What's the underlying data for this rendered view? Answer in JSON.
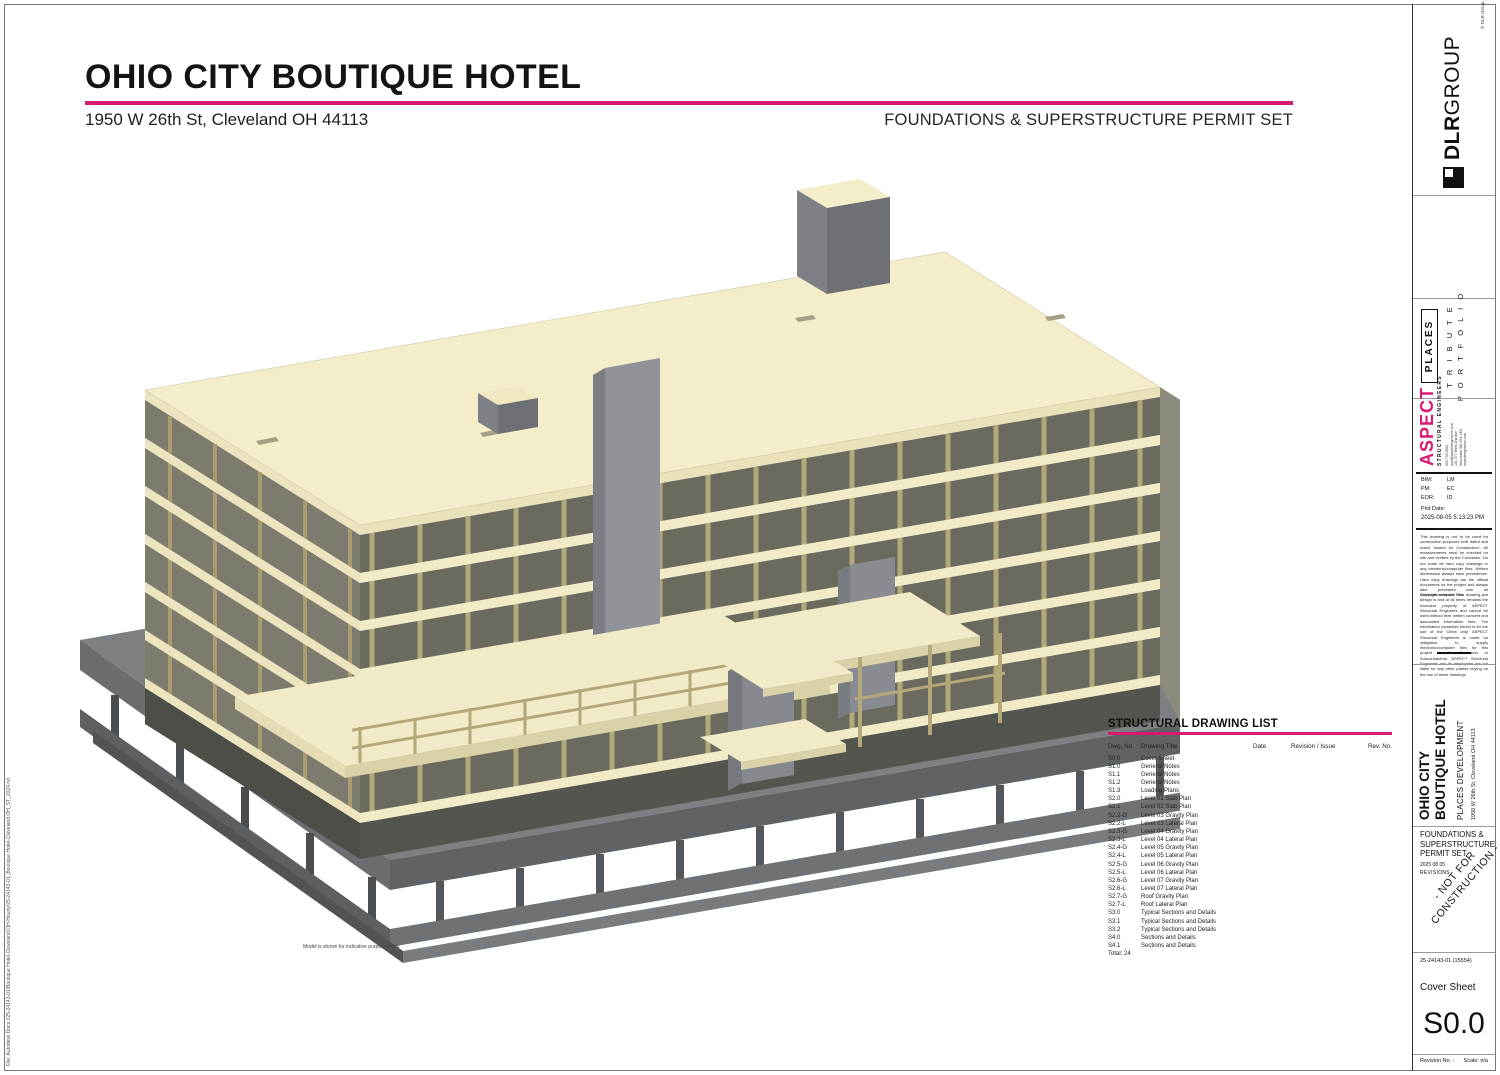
{
  "header": {
    "title": "OHIO CITY BOUTIQUE HOTEL",
    "address": "1950 W 26th St, Cleveland OH 44113",
    "set_title": "FOUNDATIONS & SUPERSTRUCTURE PERMIT SET"
  },
  "model_note": "Model is shown for indicative purposes only.",
  "file_path": "File:  Autodesk Docs://25-24143-01/Boutique Hotel-Cleveland  OH-Hourly/25-24143-01_Boutique Hotel-Cleveland OH_ST_2024.rvt",
  "drawing_list": {
    "title": "STRUCTURAL DRAWING LIST",
    "columns": [
      "Dwg. No.",
      "Drawing Title",
      "Date",
      "Revision / Issue",
      "Rev. No."
    ],
    "rows": [
      {
        "no": "S0.0",
        "title": "Cover Sheet"
      },
      {
        "no": "S1.0",
        "title": "General Notes"
      },
      {
        "no": "S1.1",
        "title": "General Notes"
      },
      {
        "no": "S1.2",
        "title": "General Notes"
      },
      {
        "no": "S1.3",
        "title": "Loading Plans"
      },
      {
        "no": "S2.0",
        "title": "Level 01 Slab Plan"
      },
      {
        "no": "S2.1",
        "title": "Level 02 Slab Plan"
      },
      {
        "no": "S2.2-G",
        "title": "Level 03 Gravity Plan"
      },
      {
        "no": "S2.2-L",
        "title": "Level 03 Lateral Plan"
      },
      {
        "no": "S2.3-G",
        "title": "Level 04 Gravity Plan"
      },
      {
        "no": "S2.3-L",
        "title": "Level 04 Lateral Plan"
      },
      {
        "no": "S2.4-G",
        "title": "Level 05 Gravity Plan"
      },
      {
        "no": "S2.4-L",
        "title": "Level 05 Lateral Plan"
      },
      {
        "no": "S2.5-G",
        "title": "Level 06 Gravity Plan"
      },
      {
        "no": "S2.5-L",
        "title": "Level 06 Lateral Plan"
      },
      {
        "no": "S2.6-G",
        "title": "Level 07 Gravity Plan"
      },
      {
        "no": "S2.6-L",
        "title": "Level 07 Lateral Plan"
      },
      {
        "no": "S2.7-G",
        "title": "Roof Gravity Plan"
      },
      {
        "no": "S2.7-L",
        "title": "Roof Lateral Plan"
      },
      {
        "no": "S3.0",
        "title": "Typical Sections and Details"
      },
      {
        "no": "S3.1",
        "title": "Typical Sections and Details"
      },
      {
        "no": "S3.2",
        "title": "Typical Sections and Details"
      },
      {
        "no": "S4.0",
        "title": "Sections and Details"
      },
      {
        "no": "S4.1",
        "title": "Sections and Details"
      }
    ],
    "total": "Total: 24"
  },
  "title_block": {
    "firm_bold": "DLR",
    "firm_light": "GROUP",
    "firm_copyright": "© DLR Group",
    "client_badge": "PLACES",
    "brand_line1": "T R I B U T E",
    "brand_line2": "P O R T F O L I O",
    "engineer_name": "ASPECT",
    "engineer_tagline": "STRUCTURAL ENGINEERS",
    "engineer_contact": "604 734 0522\nmail@aspectengineers.com\n101 377 West 2nd Ave\nVancouver BC  V5Y 1E3\naspectengineers.com",
    "credits": [
      {
        "label": "BIM:",
        "value": "LM"
      },
      {
        "label": "PM:",
        "value": "EC"
      },
      {
        "label": "EOR:",
        "value": "ID"
      }
    ],
    "plot_date_label": "Plot Date:",
    "plot_date": "2025-08-05 5:13:23 PM",
    "disclaimer1": "This drawing is not to be used for construction purposes until dated and noted 'Issued for Construction'. All measurements must be checked on site and verified by the Contractor. Do not scale off hard copy drawings or any electronic/computer files. Written dimensions always have precedence. Hard copy drawings are the official documents for the project and always take precedent over all electronic/computer files.",
    "disclaimer2": "Copyright reserved. This drawing and design is and at all times remains the exclusive property of ASPECT Structural Engineers and cannot be used without their written consent and associated information fees. The information contained herein is for the use of the Client only. ASPECT Structural Engineers is under no obligation to supply electronic/computer files for this project to the Contractor or Subcontractors. ASPECT Structural Engineers and its employees are not liable for any other parties relying on the use of these drawings.",
    "project_name_line1": "OHIO CITY",
    "project_name_line2": "BOUTIQUE HOTEL",
    "project_client": "PLACES DEVELOPMENT",
    "project_address": "1950 W 26th St, Cleveland OH 44113",
    "issue_set": "FOUNDATIONS & SUPERSTRUCTURE PERMIT SET",
    "issue_date": "2025 08 05",
    "revisions_label": "REVISIONS",
    "watermark_line1": "- NOT FOR",
    "watermark_line2": "CONSTRUCTION -",
    "project_number": "25-24143-01 (15554)",
    "sheet_title": "Cover Sheet",
    "sheet_number": "S0.0",
    "revision_label": "Revision No. :",
    "scale_label": "Scale: n/a"
  },
  "colors": {
    "accent": "#d91a72",
    "roof": "#f3edca",
    "slab": "#f1eac6",
    "opening": "#6a6b5e",
    "tan": "#b3a87a",
    "core": "#8f9398",
    "podium": "#7d8083",
    "podium_dark": "#606366"
  }
}
